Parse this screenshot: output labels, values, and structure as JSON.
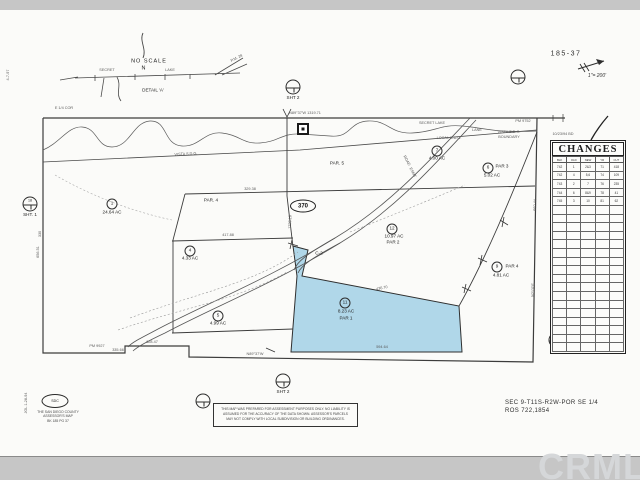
{
  "header": {
    "sheet_number": "185-37",
    "scale_label": "1\"= 200'",
    "handwritten_note": "10/23/94 BD"
  },
  "changes_table": {
    "title": "CHANGES",
    "columns": [
      "BLK",
      "OLD",
      "NEW",
      "YR",
      "CUT"
    ],
    "rows": [
      [
        "742",
        "1",
        "2&3",
        "71",
        "418"
      ],
      [
        "742",
        "4",
        "5,6",
        "74",
        "109"
      ],
      [
        "743",
        "2",
        "7",
        "76",
        "235"
      ],
      [
        "744",
        "6",
        "8&9",
        "78",
        "41"
      ],
      [
        "745",
        "3",
        "10",
        "81",
        "62"
      ]
    ],
    "empty_rows": 17
  },
  "map": {
    "oval_label": "370",
    "parcel_numbers": [
      {
        "n": "1",
        "x": 112,
        "y": 204
      },
      {
        "n": "4",
        "x": 190,
        "y": 251
      },
      {
        "n": "5",
        "x": 218,
        "y": 316
      },
      {
        "n": "7",
        "x": 437,
        "y": 151
      },
      {
        "n": "6",
        "x": 488,
        "y": 168
      },
      {
        "n": "12",
        "x": 392,
        "y": 229
      },
      {
        "n": "9",
        "x": 497,
        "y": 267
      },
      {
        "n": "11",
        "x": 345,
        "y": 303
      }
    ],
    "refs": [
      {
        "x": 293,
        "y": 87,
        "inner": "",
        "label": "SHT 2"
      },
      {
        "x": 518,
        "y": 77,
        "inner": "",
        "label": ""
      },
      {
        "x": 30,
        "y": 204,
        "inner": "18",
        "label": "SHT. 1"
      },
      {
        "x": 556,
        "y": 340,
        "inner": "196",
        "label": ""
      },
      {
        "x": 283,
        "y": 381,
        "inner": "",
        "label": "SHT 2"
      },
      {
        "x": 203,
        "y": 401,
        "inner": "",
        "label": ""
      }
    ],
    "labels": [
      {
        "t": "24.64 AC",
        "x": 112,
        "y": 213,
        "c": "c4"
      },
      {
        "t": "4.33 AC",
        "x": 190,
        "y": 259,
        "c": "c4"
      },
      {
        "t": "4.99 AC",
        "x": 218,
        "y": 324,
        "c": "c4"
      },
      {
        "t": "4.00 AC",
        "x": 437,
        "y": 159,
        "c": "c4"
      },
      {
        "t": "PAR 3",
        "x": 502,
        "y": 167,
        "c": "c4"
      },
      {
        "t": "5.02 AC",
        "x": 492,
        "y": 176,
        "c": "c4"
      },
      {
        "t": "10.97 AC",
        "x": 394,
        "y": 237,
        "c": "c4"
      },
      {
        "t": "PAR 2",
        "x": 393,
        "y": 243,
        "c": "c4"
      },
      {
        "t": "PAR 4",
        "x": 512,
        "y": 267,
        "c": "c4"
      },
      {
        "t": "4.81 AC",
        "x": 501,
        "y": 276,
        "c": "c4"
      },
      {
        "t": "8.23 AC",
        "x": 346,
        "y": 312,
        "c": "c4"
      },
      {
        "t": "PAR 1",
        "x": 346,
        "y": 319,
        "c": "c4"
      },
      {
        "t": "PAR. 4",
        "x": 211,
        "y": 201,
        "c": "c4"
      },
      {
        "t": "PAR. 5",
        "x": 337,
        "y": 164,
        "c": "c4"
      },
      {
        "t": "C-2",
        "x": 319,
        "y": 254,
        "c": "c4"
      },
      {
        "t": "VISTA S.D.G.",
        "x": 186,
        "y": 155,
        "c": "g35",
        "r": -3
      },
      {
        "t": "LOCAL S.D.G.",
        "x": 449,
        "y": 139,
        "c": "g35"
      },
      {
        "t": "VISTA S.D.G.",
        "x": 509,
        "y": 133,
        "c": "g35"
      },
      {
        "t": "BOUNDARY",
        "x": 509,
        "y": 138,
        "c": "g35"
      },
      {
        "t": "SECRET LAKE",
        "x": 432,
        "y": 124,
        "c": "g35"
      },
      {
        "t": "LANE",
        "x": 477,
        "y": 131,
        "c": "g35"
      },
      {
        "t": "PM 9752",
        "x": 523,
        "y": 122,
        "c": "g35"
      },
      {
        "t": "PM 9927",
        "x": 97,
        "y": 347,
        "c": "g35"
      },
      {
        "t": "E 1/4 COR",
        "x": 64,
        "y": 109,
        "c": "g35"
      },
      {
        "t": "ROAD",
        "x": 406,
        "y": 161,
        "c": "g35",
        "r": 62
      },
      {
        "t": "ESMT",
        "x": 412,
        "y": 173,
        "c": "g35",
        "r": 62
      },
      {
        "t": "N89°37'W 1319.71",
        "x": 305,
        "y": 114,
        "c": "g35"
      },
      {
        "t": "660.44",
        "x": 536,
        "y": 205,
        "c": "g35",
        "r": -88
      },
      {
        "t": "N2°07'E",
        "x": 534,
        "y": 290,
        "c": "g35",
        "r": -88
      },
      {
        "t": "656.51",
        "x": 39,
        "y": 252,
        "c": "g35",
        "r": -90
      },
      {
        "t": "330",
        "x": 41,
        "y": 234,
        "c": "g35",
        "r": -90
      },
      {
        "t": "329.38",
        "x": 250,
        "y": 190,
        "c": "g35"
      },
      {
        "t": "417.88",
        "x": 228,
        "y": 236,
        "c": "g35"
      },
      {
        "t": "436.70",
        "x": 382,
        "y": 289,
        "c": "g35",
        "r": -11
      },
      {
        "t": "594.64",
        "x": 382,
        "y": 348,
        "c": "g35"
      },
      {
        "t": "N89°37'W",
        "x": 255,
        "y": 355,
        "c": "g35"
      },
      {
        "t": "628.47",
        "x": 152,
        "y": 343,
        "c": "g35"
      },
      {
        "t": "335.66",
        "x": 118,
        "y": 351,
        "c": "g35"
      },
      {
        "t": "1226.18",
        "x": 291,
        "y": 222,
        "c": "g35",
        "r": -88
      },
      {
        "t": "NO SCALE",
        "x": 149,
        "y": 62,
        "c": "c5"
      },
      {
        "t": "N",
        "x": 144,
        "y": 69,
        "c": "c5"
      },
      {
        "t": "DETAIL 'A'",
        "x": 153,
        "y": 91,
        "c": "c4"
      },
      {
        "t": "SECRET",
        "x": 107,
        "y": 71,
        "c": "g35"
      },
      {
        "t": "LAKE",
        "x": 170,
        "y": 71,
        "c": "g35"
      },
      {
        "t": "P.M. 28",
        "x": 237,
        "y": 59,
        "c": "g35",
        "r": -27
      },
      {
        "t": "4-7-97",
        "x": 9,
        "y": 75,
        "c": "g35",
        "r": -90
      },
      {
        "t": "JGL 1-28-94",
        "x": 27,
        "y": 403,
        "c": "g35",
        "r": -90
      },
      {
        "t": "10/23/94 BD",
        "x": 563,
        "y": 135,
        "c": "g35"
      }
    ]
  },
  "footer": {
    "disclaimer_lines": [
      "THIS MAP WAS PREPARED FOR ASSESSMENT PURPOSES ONLY. NO LIABILITY IS",
      "ASSUMED FOR THE ACCURACY OF THE DATA SHOWN. ASSESSOR'S PARCELS",
      "MAY NOT COMPLY WITH LOCAL SUBDIVISION OR BUILDING ORDINANCES."
    ],
    "stamp": {
      "oval_text": "SDC",
      "lines": [
        "THE SAN DIEGO COUNTY",
        "ASSESSOR'S MAP",
        "BK 185 PG 37"
      ]
    },
    "section_ref_line1": "SEC 9-T11S-R2W-POR SE 1/4",
    "section_ref_line2": "ROS 722,1854"
  },
  "watermark": {
    "text": "CRMLS"
  },
  "colors": {
    "paper": "#fbfbf9",
    "scan_band": "#c6c6c6",
    "line": "#3c3c3c",
    "highlight_fill": "#a7d3e7",
    "watermark": "#d5d7d9"
  }
}
